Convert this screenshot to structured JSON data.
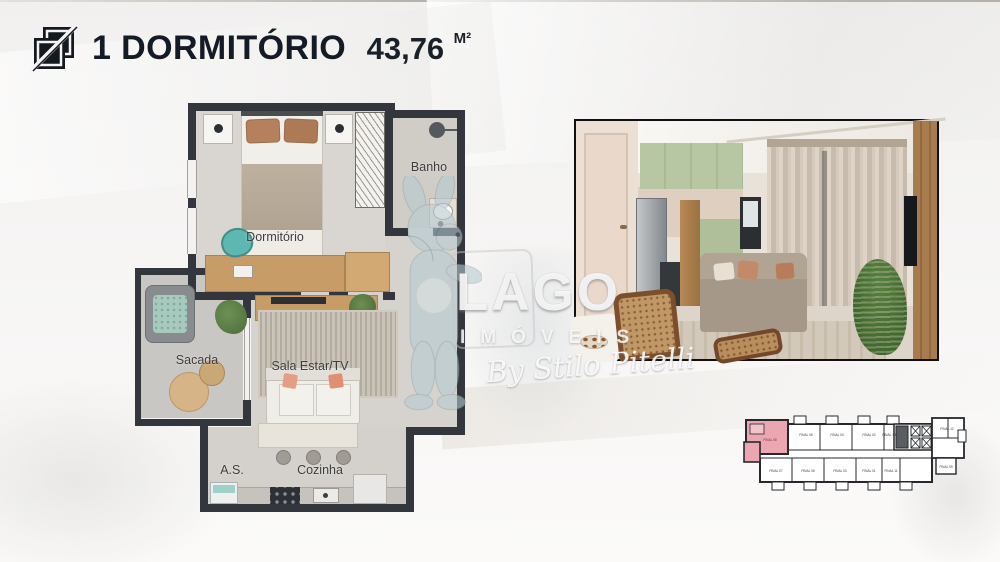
{
  "header": {
    "title": "1 DORMITÓRIO",
    "area_value": "43,76",
    "area_unit": "M²",
    "logo_icon": "overlapping-squares-logo"
  },
  "floor_plan": {
    "labels": {
      "dormitorio": "Dormitório",
      "banho": "Banho",
      "sacada": "Sacada",
      "sala": "Sala Estar/TV",
      "as": "A.S.",
      "cozinha": "Cozinha"
    }
  },
  "watermark": {
    "brand": "LAGO",
    "brand_line2": "IMÓVEIS",
    "signature": "By Stilo Pitelli"
  },
  "keyplan": {
    "highlighted_unit": "FINAL 08",
    "highlight_color": "#eba6b1",
    "units": [
      "FINAL 08",
      "FINAL 06",
      "FINAL 04",
      "FINAL 02",
      "FINAL 10",
      "FINAL 12",
      "FINAL 07",
      "FINAL 05",
      "FINAL 03",
      "FINAL 01",
      "FINAL 11",
      "FINAL 09"
    ]
  },
  "colors": {
    "title_text": "#151b24",
    "plan_wall": "#33373d",
    "plan_floor": "#d6d3ce",
    "wood": "#c79c67",
    "teal_chair": "#5fb7b2",
    "accent_pink": "#eba6b1",
    "photo_border": "#101010",
    "cabinet_green": "#b8c7a3",
    "sofa_taupe": "#a89b8a",
    "plant_green": "#4e7c3a"
  }
}
